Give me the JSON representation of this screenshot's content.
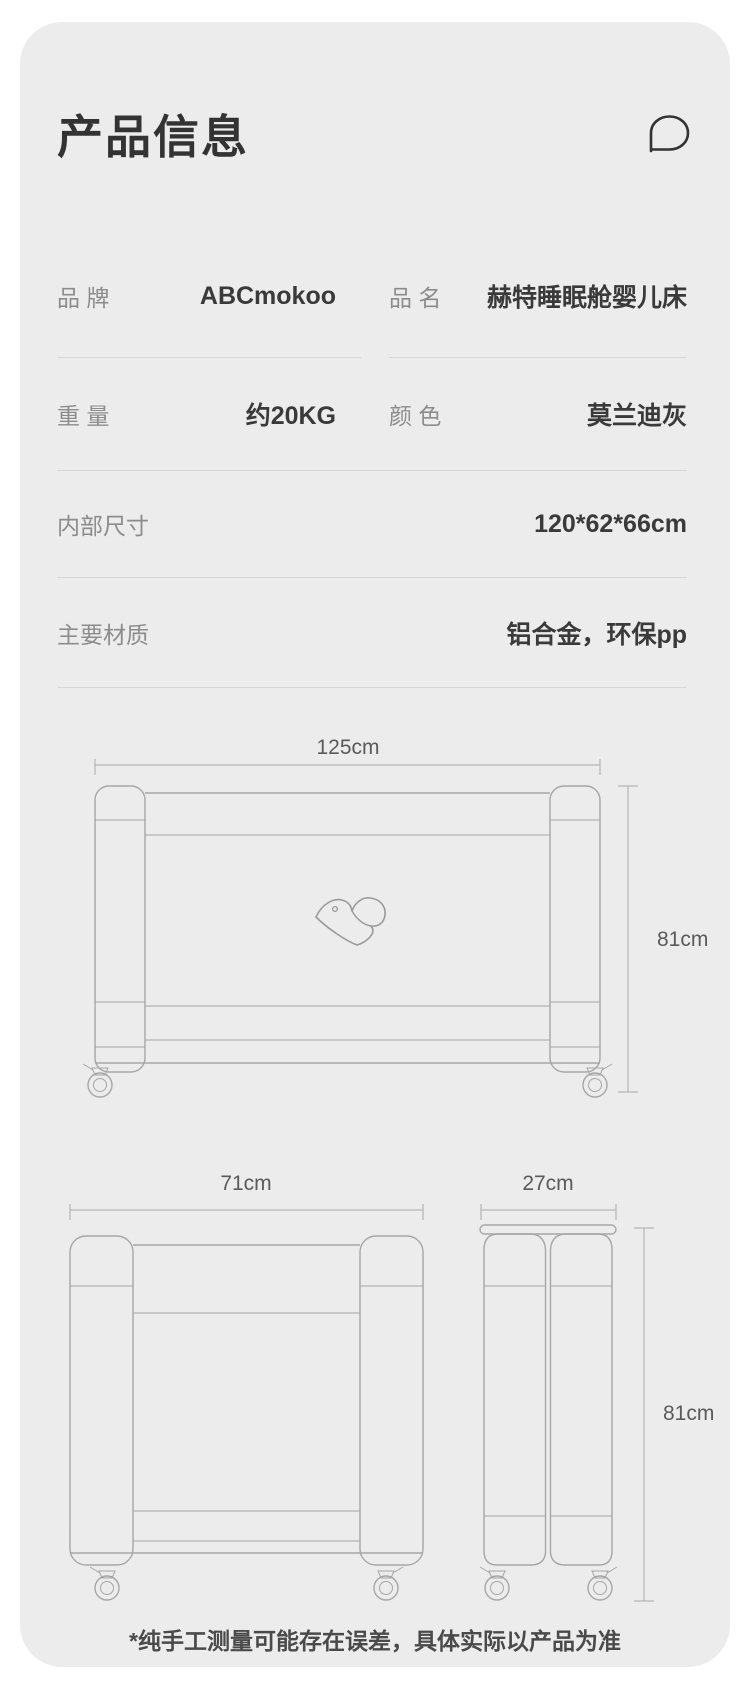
{
  "header": {
    "title": "产品信息",
    "icon": "chat-bubble-icon"
  },
  "spec_table": {
    "row1": {
      "left": {
        "label": "品 牌",
        "value": "ABCmokoo"
      },
      "right": {
        "label": "品 名",
        "value": "赫特睡眠舱婴儿床"
      }
    },
    "row2": {
      "left": {
        "label": "重 量",
        "value": "约20KG"
      },
      "right": {
        "label": "颜 色",
        "value": "莫兰迪灰"
      }
    },
    "row3": {
      "label": "内部尺寸",
      "value": "120*62*66cm"
    },
    "row4": {
      "label": "主要材质",
      "value": "铝合金，环保pp"
    }
  },
  "diagrams": {
    "front_view": {
      "width": "125cm",
      "height": "81cm"
    },
    "end_view": {
      "width": "71cm"
    },
    "folded_view": {
      "width": "27cm",
      "height": "81cm"
    }
  },
  "footer": {
    "note": "*纯手工测量可能存在误差，具体实际以产品为准"
  },
  "colors": {
    "page_bg": "#ffffff",
    "card_bg": "#ececec",
    "text_dark": "#3a3a3a",
    "text_gray": "#8c8c8c",
    "divider": "#d7d7d7",
    "drawing_line": "#a6a6a6",
    "dim_text": "#5a5a5a"
  }
}
